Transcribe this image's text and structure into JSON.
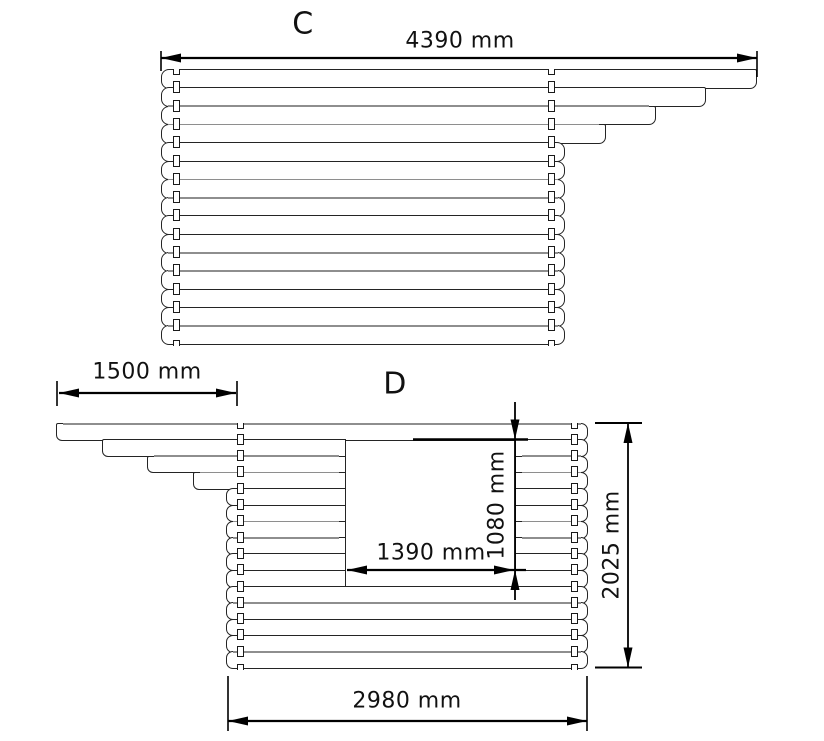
{
  "drawing": {
    "type": "log-wall elevation technical drawing",
    "views": {
      "c": {
        "label": "C",
        "width_dim": "4390 mm"
      },
      "d": {
        "label": "D",
        "overhang_dim": "1500 mm",
        "opening_width_dim": "1390 mm",
        "opening_height_dim": "1080 mm",
        "wall_height_dim": "2025 mm",
        "wall_width_dim": "2980 mm"
      }
    }
  },
  "geometry": {
    "views": [
      {
        "name": "view-c",
        "top": 69,
        "rowH": 18.3,
        "rows": 15,
        "edgeLeftX": 161,
        "edgeRightX": 565,
        "endR": 8,
        "leftEdges": [
          161,
          161,
          161,
          161,
          161,
          161,
          161,
          161,
          161,
          161,
          161,
          161,
          161,
          161,
          161
        ],
        "rightEdges": [
          757,
          706,
          656,
          606,
          565,
          565,
          565,
          565,
          565,
          565,
          565,
          565,
          565,
          565,
          565
        ],
        "window": null,
        "tongueCols": [
          176,
          551
        ],
        "tongueW": 7,
        "tongueH": 12,
        "grayJoints": [
          2,
          3,
          6,
          7,
          10,
          11,
          14
        ]
      },
      {
        "name": "view-d",
        "top": 423,
        "rowH": 16.3,
        "rows": 15,
        "edgeLeftX": 226,
        "edgeRightX": 588,
        "endR": 7,
        "leftEdges": [
          56,
          102,
          147,
          193,
          226,
          226,
          226,
          226,
          226,
          226,
          226,
          226,
          226,
          226,
          226
        ],
        "rightEdges": [
          588,
          588,
          588,
          588,
          588,
          588,
          588,
          588,
          588,
          588,
          588,
          588,
          588,
          588,
          588
        ],
        "window": {
          "x1": 346,
          "x2": 515,
          "rowStart": 1,
          "rowEnd": 9
        },
        "tongueCols": [
          240,
          574
        ],
        "tongueW": 7,
        "tongueH": 11,
        "grayJoints": [
          0,
          2,
          3,
          6,
          7,
          11,
          14
        ]
      }
    ],
    "svg": {
      "lines": [
        [
          161,
          58,
          757,
          58,
          2.2
        ],
        [
          161,
          51,
          161,
          71,
          1.6
        ],
        [
          757,
          51,
          757,
          77,
          1.6
        ],
        [
          59,
          393,
          236,
          393,
          2.2
        ],
        [
          57,
          381,
          57,
          406,
          1.6
        ],
        [
          237,
          381,
          237,
          406,
          1.6
        ],
        [
          347,
          570,
          526,
          570,
          2.2
        ],
        [
          515,
          402,
          515,
          600,
          1.8
        ],
        [
          413,
          439.5,
          528,
          439.5,
          2.6
        ],
        [
          628,
          423,
          628,
          667.5,
          1.8
        ],
        [
          595,
          423,
          642,
          423,
          2
        ],
        [
          595,
          667.5,
          642,
          667.5,
          2
        ],
        [
          228,
          721,
          587,
          721,
          2.2
        ],
        [
          228,
          676,
          228,
          731,
          1.6
        ],
        [
          587,
          676,
          587,
          731,
          1.6
        ]
      ],
      "arrows": [
        [
          161,
          58,
          "left"
        ],
        [
          757,
          58,
          "right"
        ],
        [
          59,
          393,
          "left"
        ],
        [
          236,
          393,
          "right"
        ],
        [
          347,
          570,
          "left"
        ],
        [
          514,
          570,
          "right"
        ],
        [
          515,
          439.5,
          "down"
        ],
        [
          515,
          570,
          "up"
        ],
        [
          628,
          423,
          "up"
        ],
        [
          628,
          667.5,
          "down"
        ],
        [
          228,
          721,
          "left"
        ],
        [
          587,
          721,
          "right"
        ]
      ]
    }
  }
}
